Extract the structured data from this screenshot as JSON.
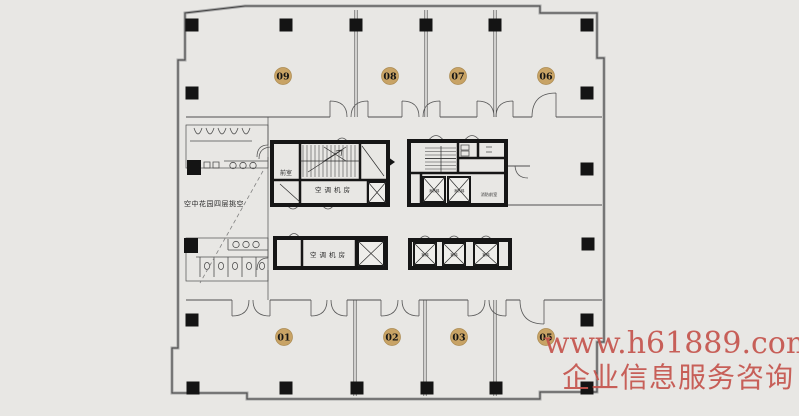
{
  "units": {
    "top": [
      {
        "label": "09"
      },
      {
        "label": "08"
      },
      {
        "label": "07"
      },
      {
        "label": "06"
      }
    ],
    "bottom": [
      {
        "label": "01"
      },
      {
        "label": "02"
      },
      {
        "label": "03"
      },
      {
        "label": "05"
      }
    ]
  },
  "labels": {
    "anteroom": "前室",
    "hvac_upper": "空调机房",
    "hvac_lower": "空调机房",
    "sky_garden": "空中花园四层挑空",
    "fire_lobby": "消防前室",
    "elev_fire": "消防梯",
    "elev_passenger": "客梯"
  },
  "watermark": {
    "line1": "www.h61889.com",
    "line2": "企业信息服务咨询"
  },
  "colors": {
    "background": "#e8e7e4",
    "wall": "#4f4f4f",
    "core_wall": "#161616",
    "badge_fill": "#c8a365",
    "badge_border": "#ab8a50",
    "watermark": "#c5544d"
  }
}
